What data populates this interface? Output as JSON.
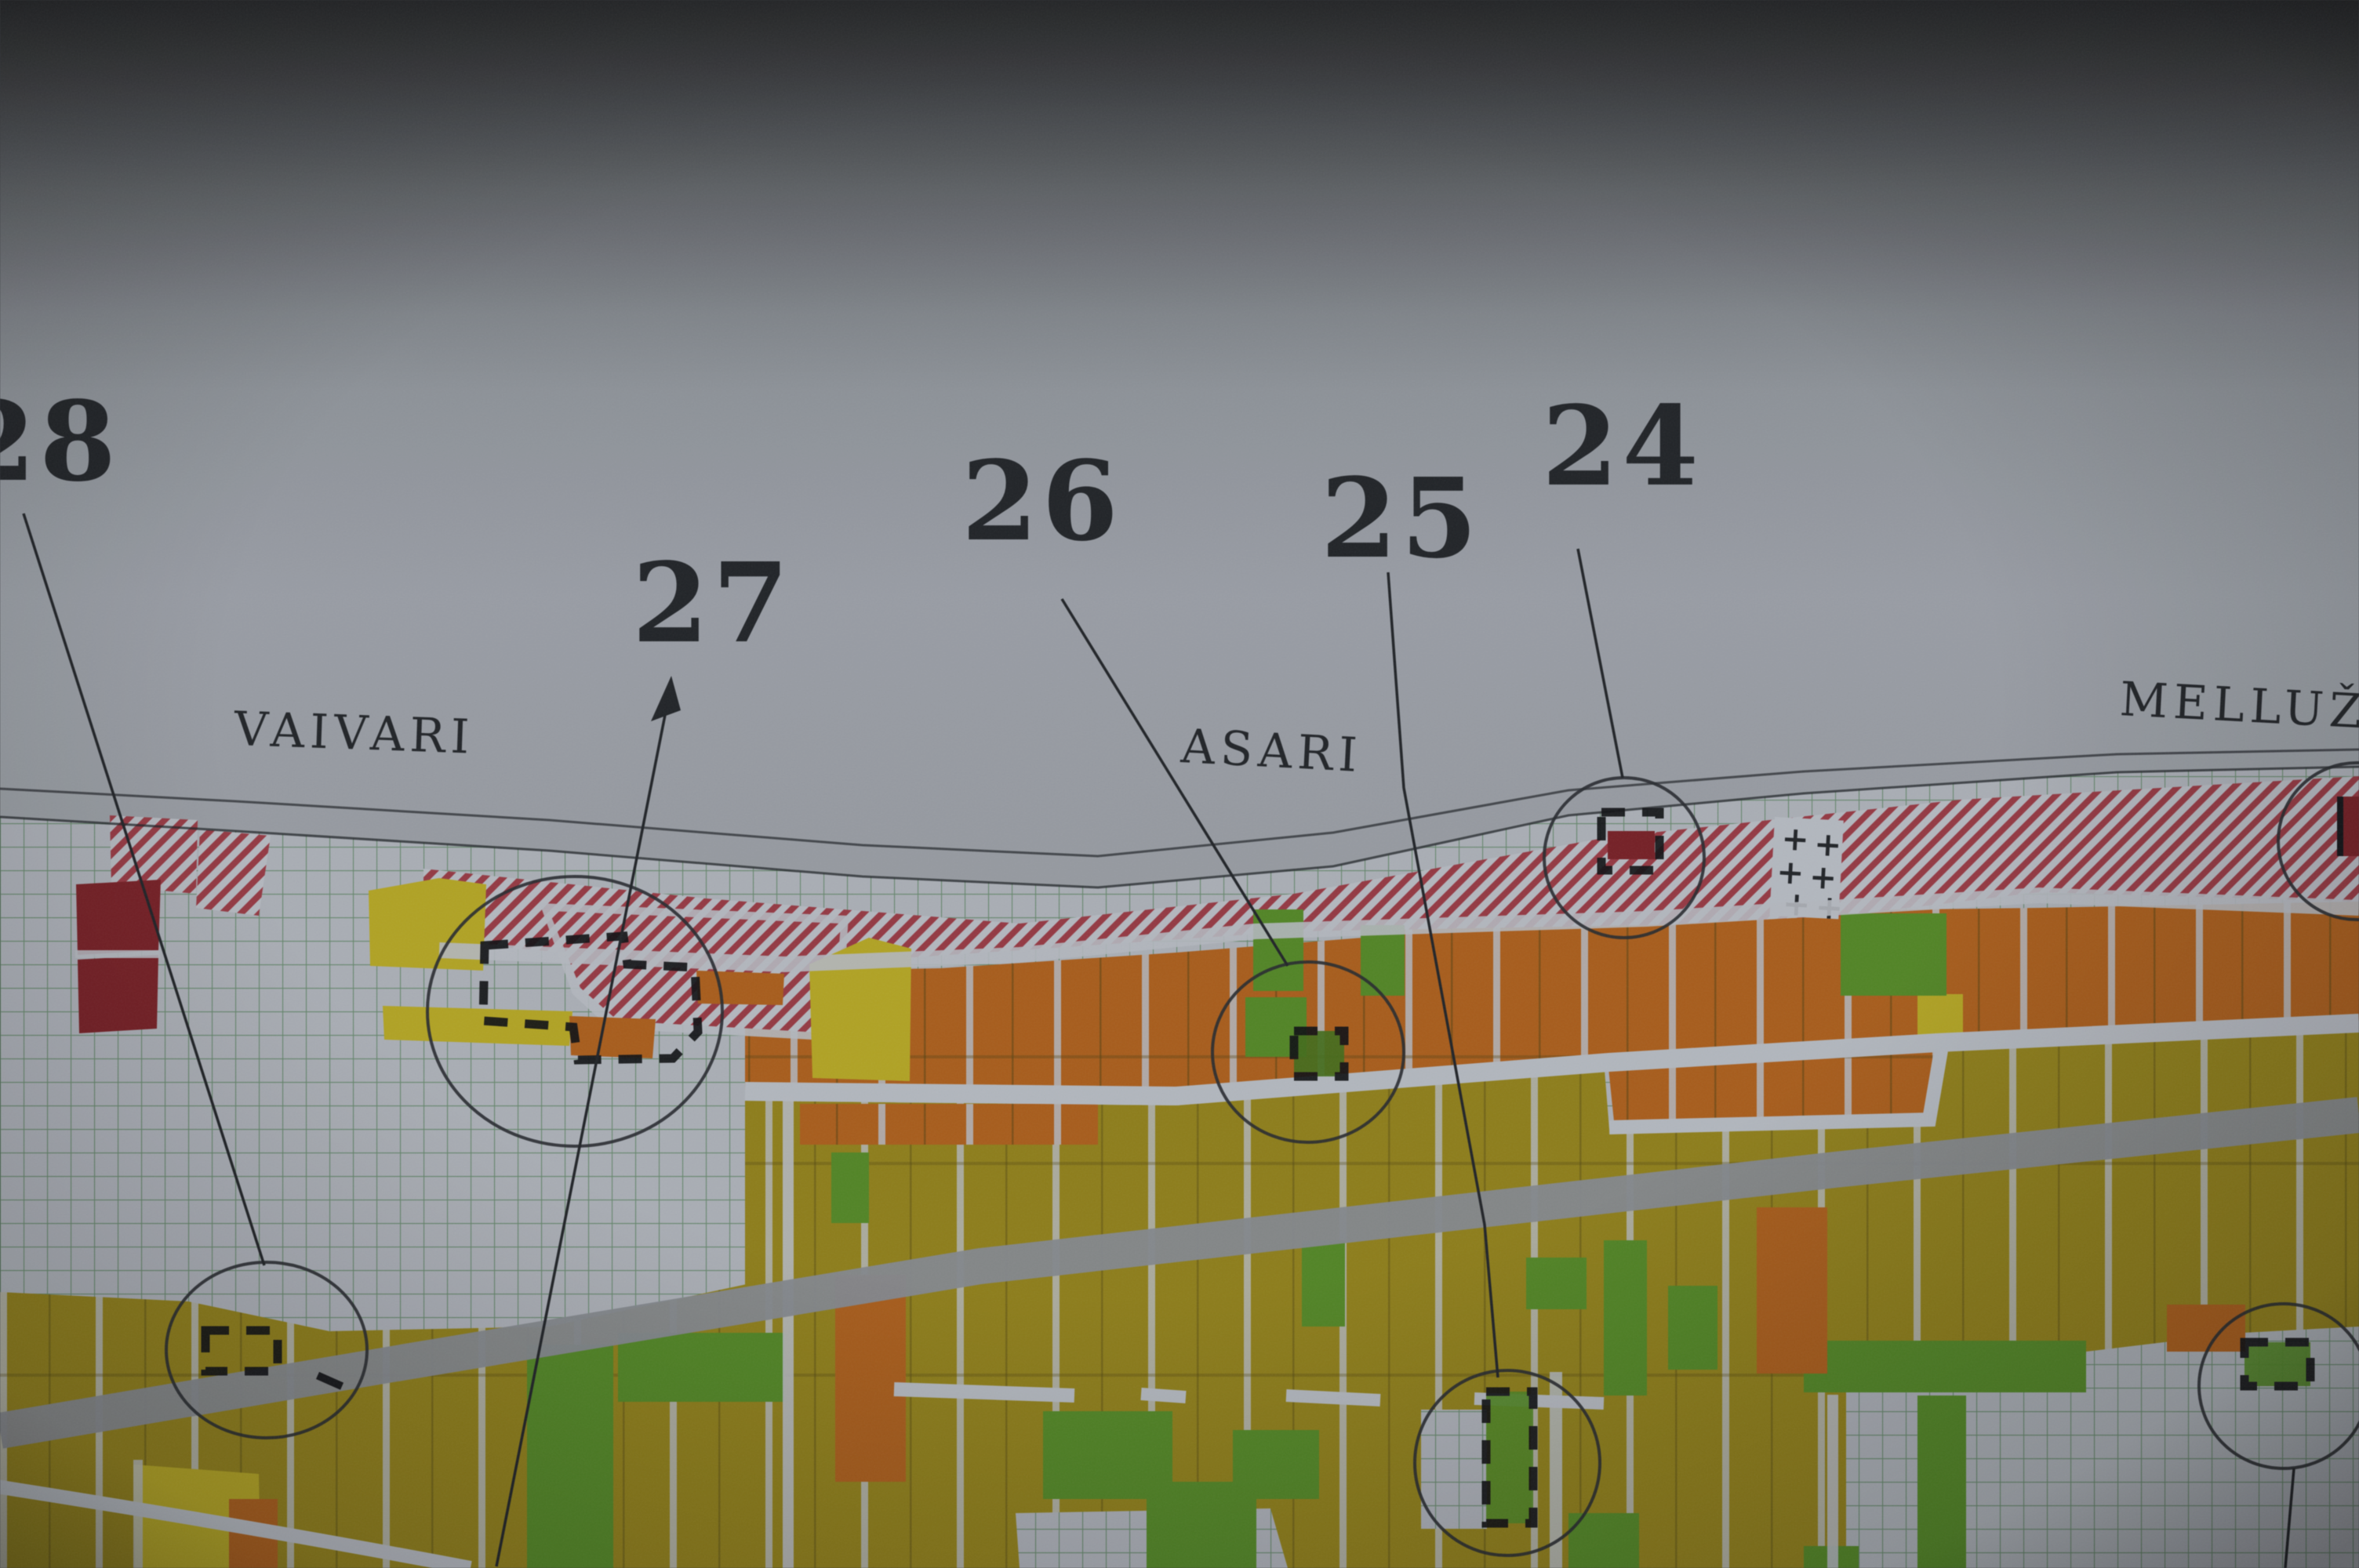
{
  "scene": {
    "kind": "photograph of a printed parcel zoning map with hand-drawn numbered site annotations"
  },
  "map": {
    "districts": [
      {
        "name": "VAIVARI"
      },
      {
        "name": "ASARI"
      },
      {
        "name": "MELLUŽ"
      }
    ],
    "markers": [
      {
        "label": "28"
      },
      {
        "label": "27"
      },
      {
        "label": "26"
      },
      {
        "label": "25"
      },
      {
        "label": "24"
      }
    ],
    "symbols": {
      "cemetery_cross": "+"
    },
    "palette": {
      "paper_dark": "#4b4e53",
      "paper_light": "#999ea6",
      "grid_bg": "#a9aeb6",
      "grid_line": "#4f7c55",
      "hatch_bg": "#b4b8c0",
      "hatch_stripe": "#9a3540",
      "orange": "#ad5a13",
      "olive": "#8f7d10",
      "green": "#4d861d",
      "dark_green": "#3f6d13",
      "yellow": "#b3a317",
      "dark_red": "#7a1c22",
      "road_white": "#b2b7bf",
      "road_gray": "#82868c",
      "ink": "#1e2126"
    }
  }
}
